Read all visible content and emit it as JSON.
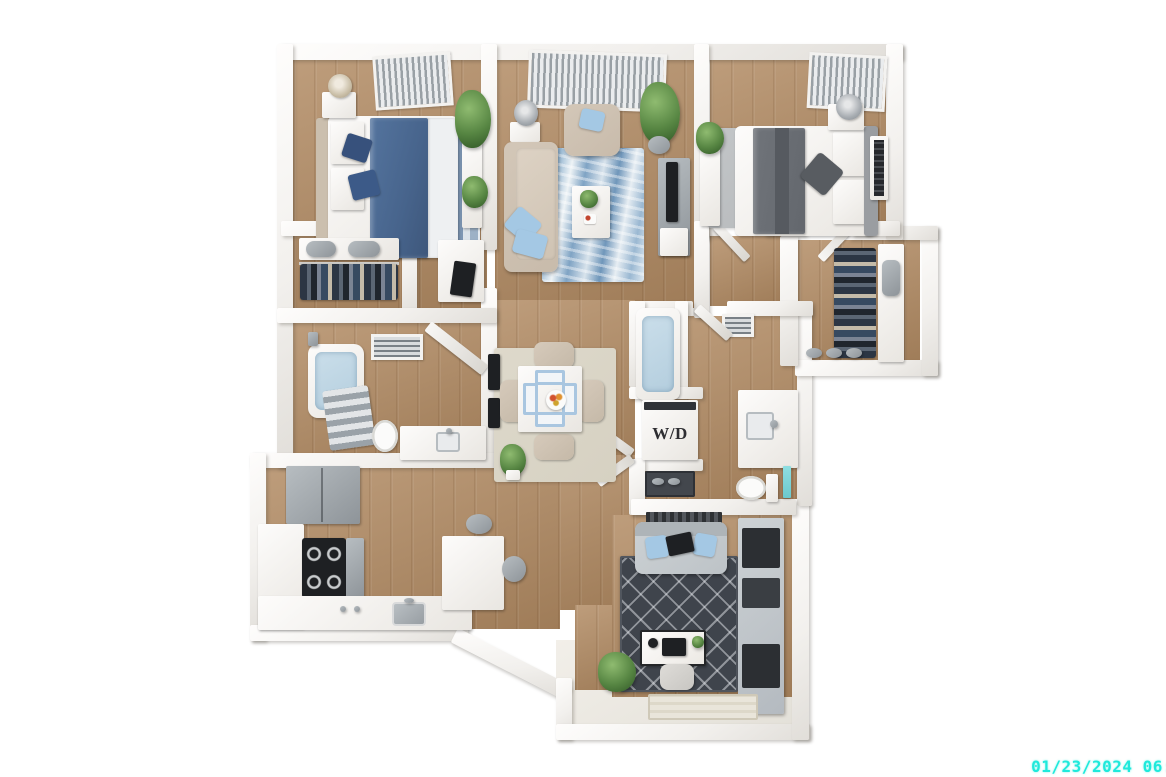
{
  "overlay": {
    "timestamp": "01/23/2024 06:"
  },
  "labels": {
    "washer_dryer": "W/D"
  },
  "colors": {
    "background": "#ffffff",
    "wall": "#f2f0ed",
    "floor-wood": "#b18a62",
    "floor-entry": "#e3e0d8",
    "rug-living-blue": "#8fb2cf",
    "rug-dining": "#d6d1c2",
    "rug-bedroom2": "#b5b8ba",
    "rug-den": "#3f444c",
    "sofa": "#c8bbab",
    "pillow-blue": "#a4c8e4",
    "duvet-blue": "#54749e",
    "duvet-gray": "#70747a",
    "appliance-gray": "#8e9499",
    "stove-black": "#1e2023",
    "plant-green": "#578643",
    "water-blue": "#b4cede",
    "wd-text": "#2e2e32",
    "timestamp-cyan": "#1FE9DB"
  },
  "scene": {
    "type": "3d-apartment-floor-plan",
    "rooms": [
      {
        "name": "bedroom-1",
        "furniture": [
          "queen-bed",
          "nightstand",
          "table-lamp",
          "striped-area-rug",
          "plants",
          "dresser",
          "tv",
          "ceiling-vent"
        ]
      },
      {
        "name": "closet-1",
        "furniture": [
          "shelf",
          "storage-bins",
          "hanging-clothes"
        ]
      },
      {
        "name": "bathroom-1",
        "furniture": [
          "bathtub",
          "shower",
          "towel-rack",
          "toilet",
          "vanity-sink",
          "ceiling-vent",
          "wall-art"
        ]
      },
      {
        "name": "living-room",
        "furniture": [
          "sofa",
          "armchair",
          "coffee-table",
          "marble-area-rug",
          "tv-console",
          "tv",
          "floor-plants",
          "table-lamp",
          "window-blinds"
        ]
      },
      {
        "name": "dining-area",
        "furniture": [
          "dining-table",
          "four-chairs",
          "placemats",
          "fruit-bowl",
          "area-rug",
          "wall-art",
          "plant"
        ]
      },
      {
        "name": "bedroom-2",
        "furniture": [
          "queen-bed",
          "nightstand",
          "table-lamp",
          "area-rug",
          "dresser",
          "wall-art",
          "plant",
          "ceiling-vent"
        ]
      },
      {
        "name": "walk-in-closet",
        "furniture": [
          "hanging-clothes",
          "shelving",
          "wall-vacuum",
          "shoes"
        ]
      },
      {
        "name": "bathroom-2",
        "furniture": [
          "bathtub",
          "vanity-sink",
          "toilet",
          "mirror",
          "ceiling-vent"
        ]
      },
      {
        "name": "laundry-closet",
        "furniture": [
          "stacked-washer-dryer",
          "shoe-shelf"
        ]
      },
      {
        "name": "kitchen",
        "furniture": [
          "refrigerator",
          "stove-oven",
          "sink",
          "counters",
          "island",
          "bar-stools"
        ]
      },
      {
        "name": "den",
        "furniture": [
          "loveseat",
          "trellis-area-rug",
          "desk",
          "laptop",
          "desk-chair",
          "storage-unit",
          "plant",
          "window"
        ]
      },
      {
        "name": "entry",
        "furniture": [
          "doormat",
          "plant"
        ]
      }
    ]
  }
}
